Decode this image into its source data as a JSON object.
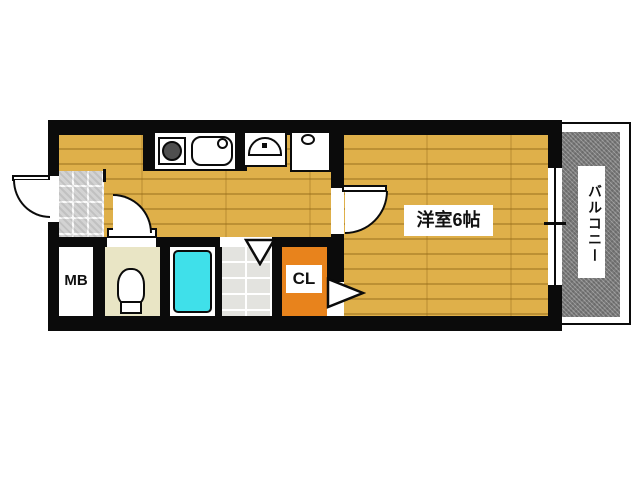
{
  "plan": {
    "type": "apartment-floor-plan",
    "labels": {
      "western_room": "洋室6帖",
      "balcony": "バルコニー",
      "meter_box": "MB",
      "closet": "CL"
    },
    "colors": {
      "wall": "#0b0b0b",
      "wood_floor": "#dfb04a",
      "balcony_deck": "#8d8d8d",
      "bathtub": "#3fe0ea",
      "closet": "#e8831c",
      "toilet_room": "#e9e5c5",
      "entry_tile": "#d3d3d3",
      "washroom_tile": "#e3e3df"
    },
    "icons": [
      "entry-door-swing-icon",
      "stove-icon",
      "kitchen-sink-icon",
      "washbasin-icon",
      "washing-machine-pan-icon",
      "toilet-icon",
      "bathtub-icon",
      "room-door-swing-icon",
      "toilet-door-swing-icon",
      "washroom-door-icon",
      "closet-door-icon",
      "window-icon",
      "entry-step-icon"
    ]
  }
}
